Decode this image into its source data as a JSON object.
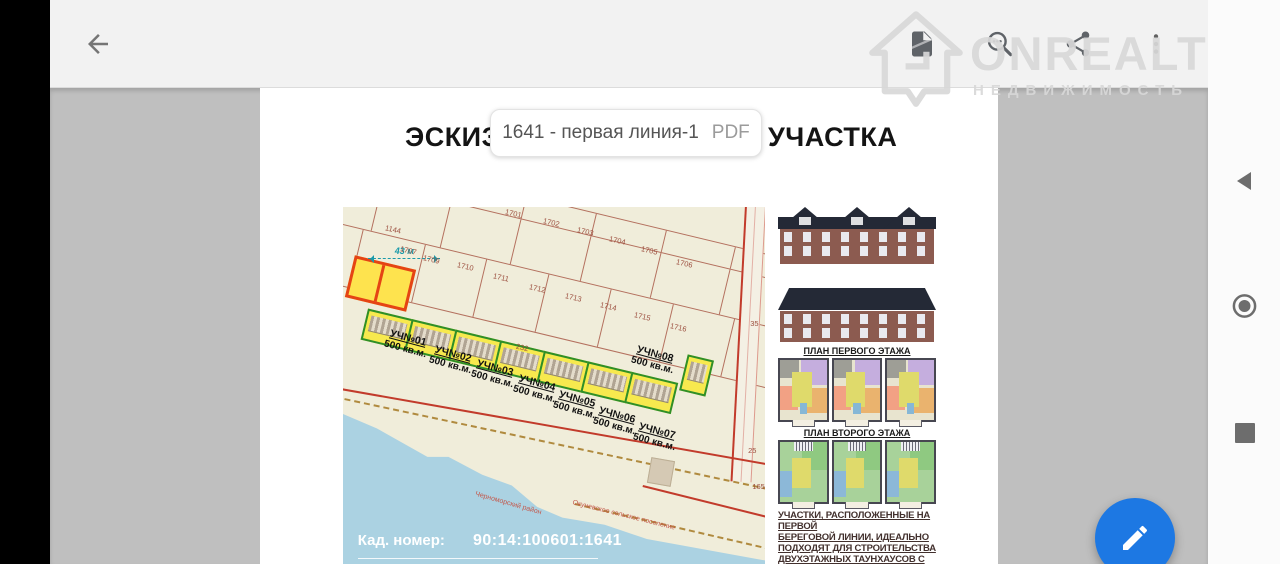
{
  "toolbar": {
    "back_icon": "arrow-left",
    "document_icon": "document-page",
    "search_icon": "magnifier-with-dots",
    "share_icon": "share-nodes",
    "menu_icon": "more-vertical"
  },
  "watermark": {
    "brand": "ONREALT",
    "tagline": "НЕДВИЖИМОСТЬ",
    "logo_icon": "house-outline"
  },
  "file_pill": {
    "name": "1641 - первая линия-1",
    "type": "PDF"
  },
  "android_nav": {
    "back_icon": "triangle-left",
    "home_icon": "double-circle",
    "recents_icon": "square"
  },
  "fab": {
    "icon": "pencil",
    "color": "#1d78e3"
  },
  "doc": {
    "title_left": "ЭСКИЗН",
    "title_right": "УЧАСТКА",
    "map": {
      "measure_label": "43 м",
      "cadastre_label": "Кад. номер:",
      "cadastre_value": "90:14:100601:1641",
      "parcel_numbers": [
        {
          "text": "1144",
          "x": 10,
          "y": 5,
          "rot": 13
        },
        {
          "text": "1701",
          "x": 38.5,
          "y": 0.5,
          "rot": 13
        },
        {
          "text": "1702",
          "x": 47.5,
          "y": 3,
          "rot": 13
        },
        {
          "text": "1703",
          "x": 55.5,
          "y": 5.5,
          "rot": 13
        },
        {
          "text": "1704",
          "x": 63,
          "y": 8,
          "rot": 13
        },
        {
          "text": "1705",
          "x": 70.5,
          "y": 11,
          "rot": 13
        },
        {
          "text": "1706",
          "x": 79,
          "y": 14.5,
          "rot": 13
        },
        {
          "text": "1707",
          "x": 13.5,
          "y": 11,
          "rot": 13
        },
        {
          "text": "1709",
          "x": 19,
          "y": 13.5,
          "rot": 13
        },
        {
          "text": "1710",
          "x": 27,
          "y": 15.5,
          "rot": 13
        },
        {
          "text": "1711",
          "x": 35.5,
          "y": 18.5,
          "rot": 13
        },
        {
          "text": "1712",
          "x": 44,
          "y": 21.5,
          "rot": 13
        },
        {
          "text": "1713",
          "x": 52.5,
          "y": 24,
          "rot": 13
        },
        {
          "text": "1714",
          "x": 61,
          "y": 26.5,
          "rot": 13
        },
        {
          "text": "1715",
          "x": 69,
          "y": 29.5,
          "rot": 13
        },
        {
          "text": "1716",
          "x": 77.5,
          "y": 32.5,
          "rot": 13
        },
        {
          "text": "232",
          "x": 41,
          "y": 38,
          "rot": 13
        },
        {
          "text": "35",
          "x": 96.5,
          "y": 31.5,
          "rot": 0
        },
        {
          "text": "25",
          "x": 96,
          "y": 67,
          "rot": 0
        },
        {
          "text": "165",
          "x": 97,
          "y": 77,
          "rot": 0
        }
      ],
      "lot_labels": [
        {
          "name": "УЧ№01",
          "area": "500 кв.м.",
          "x": 10,
          "y": 35,
          "rot": 15
        },
        {
          "name": "УЧ№02",
          "area": "500 кв.м.",
          "x": 20.5,
          "y": 39.5,
          "rot": 15
        },
        {
          "name": "УЧ№03",
          "area": "500 кв.м.",
          "x": 30.5,
          "y": 43.5,
          "rot": 15
        },
        {
          "name": "УЧ№04",
          "area": "500 кв.м.",
          "x": 40.5,
          "y": 47.5,
          "rot": 15
        },
        {
          "name": "УЧ№05",
          "area": "500 кв.м.",
          "x": 50,
          "y": 52,
          "rot": 15
        },
        {
          "name": "УЧ№06",
          "area": "500 кв.м.",
          "x": 59.5,
          "y": 56.5,
          "rot": 15
        },
        {
          "name": "УЧ№07",
          "area": "500 кв.м.",
          "x": 69,
          "y": 61,
          "rot": 15
        },
        {
          "name": "УЧ№08",
          "area": "500 кв.м.",
          "x": 68.5,
          "y": 39.5,
          "rot": 15
        }
      ],
      "place_labels": [
        {
          "text": "Черноморский район",
          "x": 31,
          "y": 82,
          "rot": 16
        },
        {
          "text": "Окуневское сельское поселение",
          "x": 54,
          "y": 85.5,
          "rot": 14
        }
      ]
    },
    "captions": {
      "floor1": "ПЛАН ПЕРВОГО ЭТАЖА",
      "floor2": "ПЛАН ВТОРОГО ЭТАЖА"
    },
    "note_lines": [
      "УЧАСТКИ, РАСПОЛОЖЕННЫЕ НА ПЕРВОЙ",
      "БЕРЕГОВОЙ ЛИНИИ, ИДЕАЛЬНО",
      "ПОДХОДЯТ ДЛЯ СТРОИТЕЛЬСТВА",
      "ДВУХЭТАЖНЫХ ТАУНХАУСОВ С",
      "МАНСАРДОЙ, КОТОРЫЕ МОГУТ"
    ]
  },
  "colors": {
    "fab_blue": "#1d78e3",
    "highlight_border": "#e54414",
    "highlight_fill": "#fee34e",
    "lot_green": "#2f8f28",
    "water_blue": "#abd2e2",
    "toolbar_bg": "#f2f2f2",
    "canvas_gray": "#bfbfbf"
  }
}
